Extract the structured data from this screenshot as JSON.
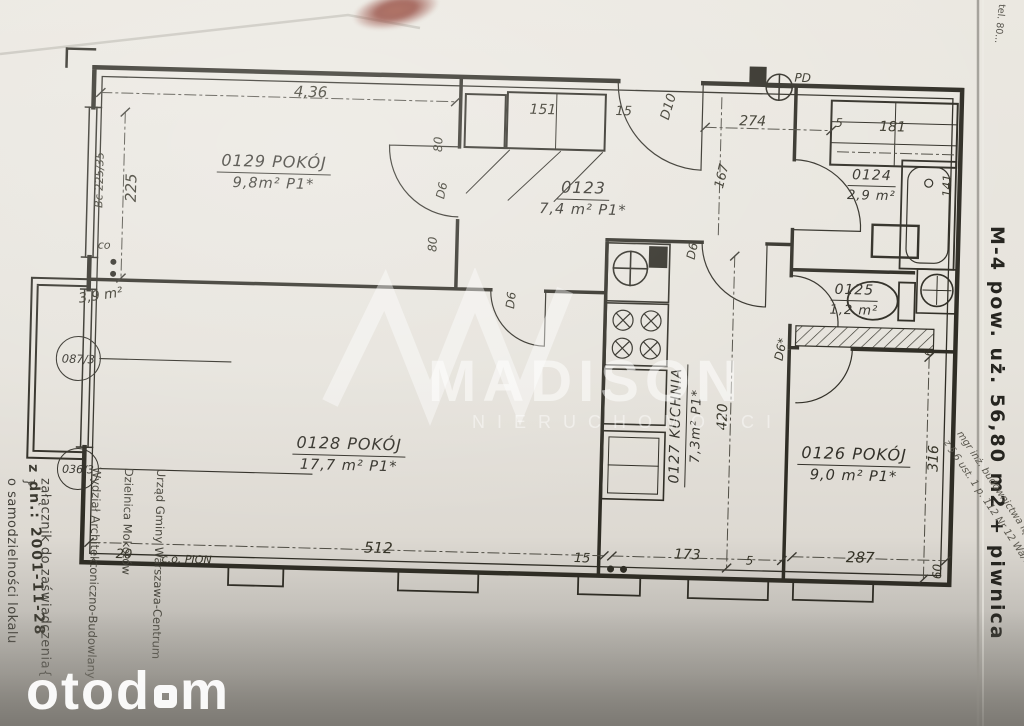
{
  "document": {
    "type": "apartment floor plan scan",
    "paper_color": "#e7e4dc",
    "ink_color": "#2f2d25"
  },
  "rooms": [
    {
      "id": "0129",
      "name": "POKÓJ",
      "area": "9,8m²",
      "floor": "P1*"
    },
    {
      "id": "0123",
      "name": "",
      "area": "7,4 m²",
      "floor": "P1*"
    },
    {
      "id": "0124",
      "name": "",
      "area": "2,9 m²",
      "floor": ""
    },
    {
      "id": "0125",
      "name": "",
      "area": "1,2 m²",
      "floor": ""
    },
    {
      "id": "0127",
      "name": "KUCHNIA",
      "area": "7,3m²",
      "floor": "P1*"
    },
    {
      "id": "0128",
      "name": "POKÓJ",
      "area": "17,7 m²",
      "floor": "P1*"
    },
    {
      "id": "0126",
      "name": "POKÓJ",
      "area": "9,0 m²",
      "floor": "P1*"
    }
  ],
  "balcony": {
    "area": "3,9 m²"
  },
  "reference_circles": [
    {
      "label": "087/3"
    },
    {
      "label": "036/3"
    }
  ],
  "doors": {
    "main": "D10",
    "a": "D6",
    "b": "D6",
    "c": "D6",
    "star": "D6*"
  },
  "dimensions": {
    "top_width": "4,36",
    "top_closet": "151",
    "top_15": "15",
    "top_274": "274",
    "top_5": "5",
    "top_181": "181",
    "top_141": "141",
    "pd": "PD",
    "left_225": "225",
    "left_window": "Bc 225/35",
    "door_80_a": "80",
    "door_80_b": "80",
    "hall_167": "167",
    "kitchen_420": "420",
    "right_316": "316",
    "right_6": "6",
    "bottom_20": "20",
    "co_pion": "c.o. PION",
    "co": "co",
    "bottom_512": "512",
    "bottom_15": "15",
    "bottom_173": "173",
    "bottom_5": "5",
    "bottom_287": "287",
    "bottom_60": "60"
  },
  "stamps": {
    "date": "z dn.: 2001-11-28",
    "attachment_line1": "załącznik do zaświadczenia",
    "attachment_line2": "o samodzielności lokalu",
    "office_line1": "Urząd Gminy Warszawa-Centrum",
    "office_line2": "Dzielnica Mokotów",
    "office_line3": "Wydział Architektoniczno-Budowlany"
  },
  "margin_notes": {
    "summary": "M-4 pow. uż. 56,80 m2 + piwnica",
    "phone": "tel. 80...",
    "note_1": "mgr inż. budownictwa lądowego",
    "note_2": "z § 6 ust. 1 p. 112 Nr 12 Wa/72"
  },
  "watermarks": {
    "brand": "MADISON",
    "brand_sub": "NIERUCHOMOŚCI",
    "portal": "otod",
    "portal_suffix": "m"
  }
}
